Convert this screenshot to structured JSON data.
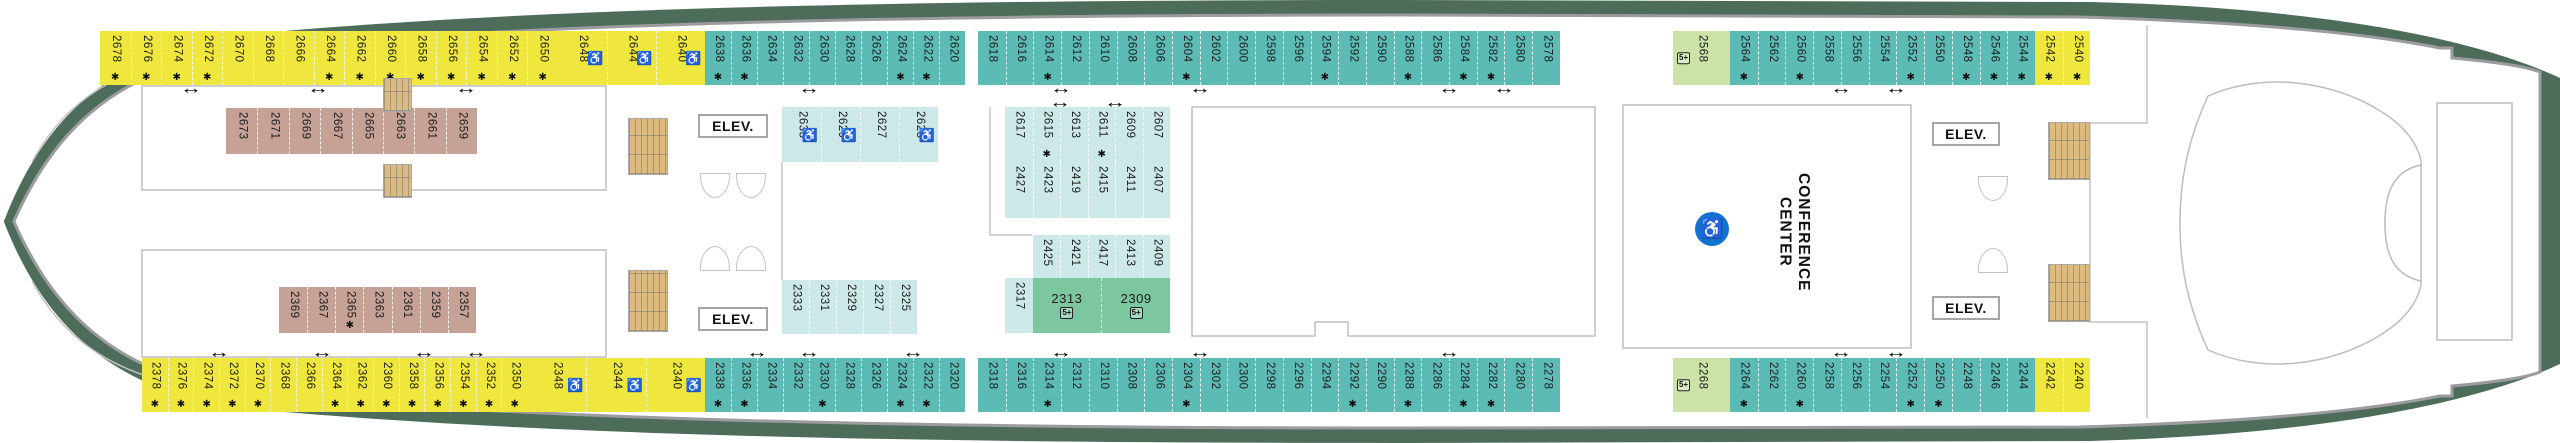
{
  "labels": {
    "elevator": "ELEV.",
    "conference_line1": "CONFERENCE",
    "conference_line2": "CENTER"
  },
  "icons": {
    "connecting_arrow": "↔",
    "star": "✱",
    "wheelchair": "♿",
    "five_plus": "5+"
  },
  "colors": {
    "yellow": "#efe73d",
    "teal": "#5cbcb5",
    "light_teal": "#cde8e8",
    "green": "#7cc6a0",
    "light_green": "#cde2a7",
    "brown": "#c6a195",
    "hull_green": "#4d6c59",
    "accent_blue": "#1173cf",
    "stairs_tan": "#dcba80"
  },
  "cabin_groups": [
    {
      "color": "yellow",
      "x": 100,
      "y": 31,
      "h": 54,
      "cw": 30.5,
      "cells": [
        {
          "n": "2678",
          "s": 1
        },
        {
          "n": "2676",
          "s": 1
        },
        {
          "n": "2674",
          "s": 1
        },
        {
          "n": "2672",
          "s": 1
        },
        {
          "n": "2670"
        },
        {
          "n": "2668"
        },
        {
          "n": "2666"
        },
        {
          "n": "2664",
          "s": 1
        },
        {
          "n": "2662",
          "s": 1
        },
        {
          "n": "2660",
          "s": 1
        },
        {
          "n": "2658",
          "s": 1
        },
        {
          "n": "2656",
          "s": 1
        },
        {
          "n": "2654",
          "s": 1
        },
        {
          "n": "2652",
          "s": 1
        },
        {
          "n": "2650",
          "s": 1
        }
      ]
    },
    {
      "color": "yellow",
      "x": 557.5,
      "y": 31,
      "h": 54,
      "cw": 49,
      "cells": [
        {
          "n": "2648",
          "w": 1
        },
        {
          "n": "2644",
          "w": 1
        },
        {
          "n": "2640",
          "w": 1
        }
      ]
    },
    {
      "color": "teal",
      "x": 705,
      "y": 31,
      "h": 54,
      "cw": 26,
      "cells": [
        {
          "n": "2638",
          "s": 1
        },
        {
          "n": "2636",
          "s": 1
        },
        {
          "n": "2634"
        },
        {
          "n": "2632"
        },
        {
          "n": "2630"
        },
        {
          "n": "2628"
        },
        {
          "n": "2626"
        },
        {
          "n": "2624",
          "s": 1
        },
        {
          "n": "2622",
          "s": 1
        },
        {
          "n": "2620"
        }
      ]
    },
    {
      "color": "teal",
      "x": 978,
      "y": 31,
      "h": 54,
      "cw": 27.71,
      "cells": [
        {
          "n": "2618"
        },
        {
          "n": "2616"
        },
        {
          "n": "2614",
          "s": 1
        },
        {
          "n": "2612"
        },
        {
          "n": "2610"
        },
        {
          "n": "2608"
        },
        {
          "n": "2606"
        },
        {
          "n": "2604",
          "s": 1
        },
        {
          "n": "2602"
        },
        {
          "n": "2600"
        },
        {
          "n": "2598"
        },
        {
          "n": "2596"
        },
        {
          "n": "2594",
          "s": 1
        },
        {
          "n": "2592"
        },
        {
          "n": "2590"
        },
        {
          "n": "2588",
          "s": 1
        },
        {
          "n": "2586"
        },
        {
          "n": "2584",
          "s": 1
        },
        {
          "n": "2582",
          "s": 1
        },
        {
          "n": "2580"
        },
        {
          "n": "2578"
        }
      ]
    },
    {
      "color": "light_green",
      "x": 1673,
      "y": 31,
      "h": 54,
      "cw": 57,
      "cells": [
        {
          "n": "2568",
          "f": 1
        }
      ]
    },
    {
      "color": "teal",
      "x": 1730,
      "y": 31,
      "h": 54,
      "cw": 27.73,
      "cells": [
        {
          "n": "2564",
          "s": 1
        },
        {
          "n": "2562"
        },
        {
          "n": "2560",
          "s": 1
        },
        {
          "n": "2558"
        },
        {
          "n": "2556"
        },
        {
          "n": "2554"
        },
        {
          "n": "2552",
          "s": 1
        },
        {
          "n": "2550"
        },
        {
          "n": "2548",
          "s": 1
        },
        {
          "n": "2546",
          "s": 1
        },
        {
          "n": "2544",
          "s": 1
        }
      ]
    },
    {
      "color": "yellow",
      "x": 2035,
      "y": 31,
      "h": 54,
      "cw": 27.7,
      "cells": [
        {
          "n": "2542",
          "s": 1
        },
        {
          "n": "2540",
          "s": 1
        }
      ]
    },
    {
      "color": "yellow",
      "x": 142,
      "y": 358,
      "h": 54,
      "cw": 25.67,
      "cells": [
        {
          "n": "2378",
          "s": 1
        },
        {
          "n": "2376",
          "s": 1
        },
        {
          "n": "2374",
          "s": 1
        },
        {
          "n": "2372",
          "s": 1
        },
        {
          "n": "2370",
          "s": 1
        },
        {
          "n": "2368"
        },
        {
          "n": "2366"
        },
        {
          "n": "2364",
          "s": 1
        },
        {
          "n": "2362",
          "s": 1
        },
        {
          "n": "2360",
          "s": 1
        },
        {
          "n": "2358",
          "s": 1
        },
        {
          "n": "2356",
          "s": 1
        },
        {
          "n": "2354",
          "s": 1
        },
        {
          "n": "2352",
          "s": 1
        },
        {
          "n": "2350",
          "s": 1
        }
      ]
    },
    {
      "color": "yellow",
      "x": 527,
      "y": 358,
      "h": 54,
      "cw": 59.33,
      "cells": [
        {
          "n": "2348",
          "w": 1
        },
        {
          "n": "2344",
          "w": 1
        },
        {
          "n": "2340",
          "w": 1
        }
      ]
    },
    {
      "color": "teal",
      "x": 705,
      "y": 358,
      "h": 54,
      "cw": 26,
      "cells": [
        {
          "n": "2338",
          "s": 1
        },
        {
          "n": "2336",
          "s": 1
        },
        {
          "n": "2334"
        },
        {
          "n": "2332"
        },
        {
          "n": "2330",
          "s": 1
        },
        {
          "n": "2328"
        },
        {
          "n": "2326"
        },
        {
          "n": "2324",
          "s": 1
        },
        {
          "n": "2322",
          "s": 1
        },
        {
          "n": "2320"
        }
      ]
    },
    {
      "color": "teal",
      "x": 978,
      "y": 358,
      "h": 54,
      "cw": 27.71,
      "cells": [
        {
          "n": "2318"
        },
        {
          "n": "2316"
        },
        {
          "n": "2314",
          "s": 1
        },
        {
          "n": "2312"
        },
        {
          "n": "2310"
        },
        {
          "n": "2308"
        },
        {
          "n": "2306"
        },
        {
          "n": "2304",
          "s": 1
        },
        {
          "n": "2302"
        },
        {
          "n": "2300"
        },
        {
          "n": "2298"
        },
        {
          "n": "2296"
        },
        {
          "n": "2294"
        },
        {
          "n": "2292",
          "s": 1
        },
        {
          "n": "2290"
        },
        {
          "n": "2288",
          "s": 1
        },
        {
          "n": "2286"
        },
        {
          "n": "2284",
          "s": 1
        },
        {
          "n": "2282",
          "s": 1
        },
        {
          "n": "2280"
        },
        {
          "n": "2278"
        }
      ]
    },
    {
      "color": "light_green",
      "x": 1673,
      "y": 358,
      "h": 54,
      "cw": 57,
      "cells": [
        {
          "n": "2268",
          "f": 1
        }
      ]
    },
    {
      "color": "teal",
      "x": 1730,
      "y": 358,
      "h": 54,
      "cw": 27.73,
      "cells": [
        {
          "n": "2264",
          "s": 1
        },
        {
          "n": "2262"
        },
        {
          "n": "2260",
          "s": 1
        },
        {
          "n": "2258"
        },
        {
          "n": "2256"
        },
        {
          "n": "2254"
        },
        {
          "n": "2252",
          "s": 1
        },
        {
          "n": "2250",
          "s": 1
        },
        {
          "n": "2248"
        },
        {
          "n": "2246"
        },
        {
          "n": "2244"
        }
      ]
    },
    {
      "color": "yellow",
      "x": 2035,
      "y": 358,
      "h": 54,
      "cw": 27.7,
      "cells": [
        {
          "n": "2242"
        },
        {
          "n": "2240"
        }
      ]
    },
    {
      "color": "brown",
      "x": 226,
      "y": 108,
      "h": 46,
      "cw": 31.4,
      "cells": [
        {
          "n": "2673"
        },
        {
          "n": "2671"
        },
        {
          "n": "2669"
        },
        {
          "n": "2667"
        },
        {
          "n": "2665"
        },
        {
          "n": "2663"
        },
        {
          "n": "2661"
        },
        {
          "n": "2659"
        }
      ]
    },
    {
      "color": "brown",
      "x": 279,
      "y": 287,
      "h": 46,
      "cw": 28.14,
      "cells": [
        {
          "n": "2369"
        },
        {
          "n": "2367"
        },
        {
          "n": "2365",
          "s": 1
        },
        {
          "n": "2363"
        },
        {
          "n": "2361"
        },
        {
          "n": "2359"
        },
        {
          "n": "2357"
        }
      ]
    },
    {
      "color": "light_teal",
      "x": 782,
      "y": 107,
      "h": 55,
      "cw": 39,
      "cells": [
        {
          "n": "2633",
          "w": 1
        },
        {
          "n": "2629",
          "w": 1
        },
        {
          "n": "2627"
        },
        {
          "n": "2623",
          "w": 1
        }
      ]
    },
    {
      "color": "light_teal",
      "x": 782,
      "y": 280,
      "h": 54,
      "cw": 27,
      "cells": [
        {
          "n": "2333"
        },
        {
          "n": "2331"
        },
        {
          "n": "2329"
        },
        {
          "n": "2327"
        },
        {
          "n": "2325"
        }
      ]
    },
    {
      "color": "light_teal",
      "x": 1005,
      "y": 107,
      "h": 55,
      "cw": 27.5,
      "cells": [
        {
          "n": "2617"
        },
        {
          "n": "2615",
          "s": 1
        },
        {
          "n": "2613"
        },
        {
          "n": "2611",
          "s": 1
        },
        {
          "n": "2609"
        },
        {
          "n": "2607"
        }
      ]
    },
    {
      "color": "light_teal",
      "x": 1005,
      "y": 162,
      "h": 56,
      "cw": 27.5,
      "cells": [
        {
          "n": "2427"
        },
        {
          "n": "2423"
        },
        {
          "n": "2419"
        },
        {
          "n": "2415"
        },
        {
          "n": "2411"
        },
        {
          "n": "2407"
        }
      ]
    },
    {
      "color": "light_teal",
      "x": 1032.5,
      "y": 235,
      "h": 43,
      "cw": 27.5,
      "cells": [
        {
          "n": "2425"
        },
        {
          "n": "2421"
        },
        {
          "n": "2417"
        },
        {
          "n": "2413"
        },
        {
          "n": "2409"
        }
      ]
    },
    {
      "color": "light_teal",
      "x": 1005,
      "y": 278,
      "h": 55,
      "cw": 27.5,
      "cells": [
        {
          "n": "2317"
        }
      ]
    },
    {
      "color": "green",
      "x": 1032.5,
      "y": 278,
      "h": 55,
      "cw": 68.75,
      "dir": "h",
      "cells": [
        {
          "n": "2313",
          "f": 1
        },
        {
          "n": "2309",
          "f": 1
        }
      ]
    }
  ],
  "arrows": [
    {
      "x": 191,
      "y": 88
    },
    {
      "x": 318,
      "y": 88
    },
    {
      "x": 466,
      "y": 88
    },
    {
      "x": 809,
      "y": 88
    },
    {
      "x": 1061,
      "y": 88
    },
    {
      "x": 1200,
      "y": 88
    },
    {
      "x": 1449,
      "y": 88
    },
    {
      "x": 1504,
      "y": 88
    },
    {
      "x": 1841,
      "y": 88
    },
    {
      "x": 1896,
      "y": 88
    },
    {
      "x": 1060,
      "y": 102
    },
    {
      "x": 1115,
      "y": 102
    },
    {
      "x": 219,
      "y": 352
    },
    {
      "x": 322,
      "y": 352
    },
    {
      "x": 424,
      "y": 352
    },
    {
      "x": 476,
      "y": 352
    },
    {
      "x": 757,
      "y": 352
    },
    {
      "x": 809,
      "y": 352
    },
    {
      "x": 913,
      "y": 352
    },
    {
      "x": 1061,
      "y": 352
    },
    {
      "x": 1200,
      "y": 352
    },
    {
      "x": 1449,
      "y": 352
    },
    {
      "x": 1841,
      "y": 352
    },
    {
      "x": 1896,
      "y": 352
    }
  ],
  "elevators": [
    {
      "x": 698,
      "y": 114,
      "w": 70,
      "h": 24
    },
    {
      "x": 698,
      "y": 307,
      "w": 70,
      "h": 24
    },
    {
      "x": 1932,
      "y": 122,
      "w": 68,
      "h": 24
    },
    {
      "x": 1932,
      "y": 296,
      "w": 68,
      "h": 24
    }
  ],
  "stairs": [
    {
      "x": 383,
      "y": 78,
      "w": 29,
      "h": 34
    },
    {
      "x": 383,
      "y": 164,
      "w": 29,
      "h": 34
    },
    {
      "x": 628,
      "y": 118,
      "w": 40,
      "h": 57
    },
    {
      "x": 628,
      "y": 270,
      "w": 40,
      "h": 62
    },
    {
      "x": 2048,
      "y": 122,
      "w": 42,
      "h": 58
    },
    {
      "x": 2048,
      "y": 264,
      "w": 42,
      "h": 58
    }
  ],
  "doors": [
    {
      "x": 700,
      "y": 173,
      "dir": "down"
    },
    {
      "x": 736,
      "y": 173,
      "dir": "down"
    },
    {
      "x": 700,
      "y": 246,
      "dir": "up"
    },
    {
      "x": 736,
      "y": 246,
      "dir": "up"
    },
    {
      "x": 1978,
      "y": 176,
      "dir": "down"
    },
    {
      "x": 1978,
      "y": 248,
      "dir": "up"
    }
  ]
}
